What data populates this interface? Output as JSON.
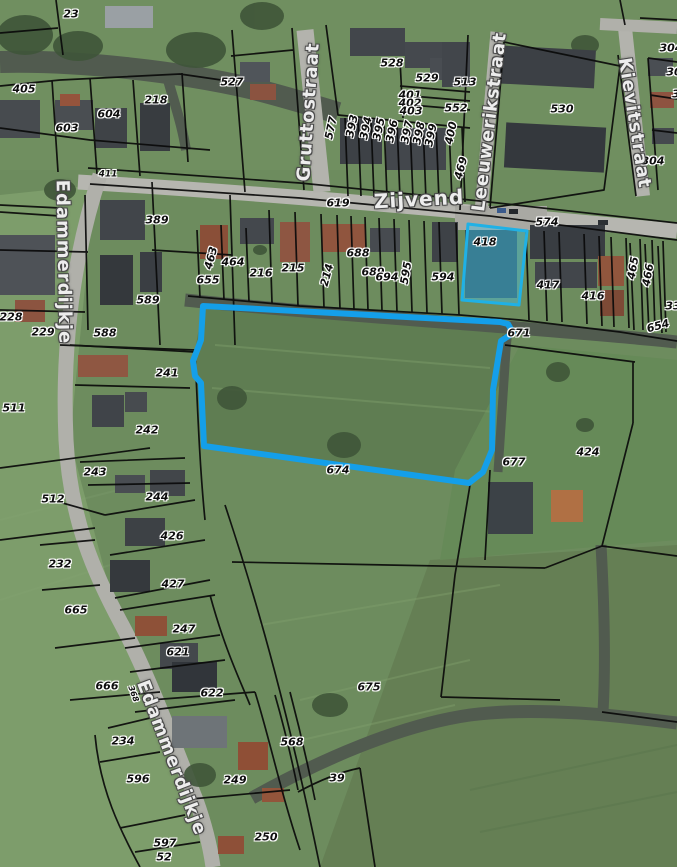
{
  "map": {
    "type": "cadastral-aerial-viewer",
    "colors": {
      "highlight_blue": "#149fe9",
      "highlight_parcel_fill": "rgba(70,195,235,0.42)",
      "highlight_parcel_stroke": "#1fb1e6",
      "parcel_line": "#0a0a0a",
      "water": "#515b4f",
      "road": "#b5b5af",
      "field": "#6d8c5e"
    },
    "highlight": {
      "field_parcel_points": "203,306 500,322 508,324 513,333 501,341 493,390 492,450 483,472 469,483 204,446 201,383 195,376 193,361 201,340",
      "building_parcel_points": "468,224 527,231 523,268 519,305 462,300",
      "building_parcel_label": "418"
    },
    "street_labels": [
      {
        "text": "Zijvend",
        "x": 419,
        "y": 199,
        "rot": -3,
        "size": 20
      },
      {
        "text": "Gruttostraat",
        "x": 309,
        "y": 112,
        "rot": -86,
        "size": 18
      },
      {
        "text": "Leeuwerikstraat",
        "x": 490,
        "y": 122,
        "rot": -83,
        "size": 18
      },
      {
        "text": "Kievitstraat",
        "x": 634,
        "y": 123,
        "rot": 81,
        "size": 18
      },
      {
        "text": "Edammerdijkje",
        "x": 63,
        "y": 262,
        "rot": 89,
        "size": 18
      },
      {
        "text": "Edammerdijkje",
        "x": 171,
        "y": 758,
        "rot": 69,
        "size": 18
      }
    ],
    "parcel_labels": [
      {
        "text": "23",
        "x": 71,
        "y": 14
      },
      {
        "text": "405",
        "x": 24,
        "y": 89
      },
      {
        "text": "603",
        "x": 67,
        "y": 128
      },
      {
        "text": "604",
        "x": 109,
        "y": 114
      },
      {
        "text": "218",
        "x": 156,
        "y": 100
      },
      {
        "text": "527",
        "x": 232,
        "y": 82
      },
      {
        "text": "528",
        "x": 392,
        "y": 63
      },
      {
        "text": "529",
        "x": 427,
        "y": 78
      },
      {
        "text": "513",
        "x": 465,
        "y": 82
      },
      {
        "text": "401",
        "x": 410,
        "y": 95
      },
      {
        "text": "402",
        "x": 410,
        "y": 103
      },
      {
        "text": "403",
        "x": 411,
        "y": 111
      },
      {
        "text": "552",
        "x": 456,
        "y": 108
      },
      {
        "text": "530",
        "x": 562,
        "y": 109
      },
      {
        "text": "304",
        "x": 671,
        "y": 48
      },
      {
        "text": "30",
        "x": 674,
        "y": 72
      },
      {
        "text": "3",
        "x": 676,
        "y": 94
      },
      {
        "text": "304",
        "x": 653,
        "y": 161
      },
      {
        "text": "577",
        "x": 331,
        "y": 128,
        "rot": -78
      },
      {
        "text": "393",
        "x": 352,
        "y": 126,
        "rot": -78
      },
      {
        "text": "394",
        "x": 366,
        "y": 128,
        "rot": -78
      },
      {
        "text": "395",
        "x": 379,
        "y": 129,
        "rot": -78
      },
      {
        "text": "396",
        "x": 392,
        "y": 131,
        "rot": -78
      },
      {
        "text": "397",
        "x": 407,
        "y": 132,
        "rot": -78
      },
      {
        "text": "398",
        "x": 419,
        "y": 133,
        "rot": -78
      },
      {
        "text": "399",
        "x": 431,
        "y": 135,
        "rot": -78
      },
      {
        "text": "400",
        "x": 451,
        "y": 133,
        "rot": -78
      },
      {
        "text": "469",
        "x": 461,
        "y": 168,
        "rot": -75
      },
      {
        "text": "411",
        "x": 108,
        "y": 175,
        "size": 9
      },
      {
        "text": "619",
        "x": 338,
        "y": 203
      },
      {
        "text": "574",
        "x": 547,
        "y": 222
      },
      {
        "text": "418",
        "x": 485,
        "y": 242
      },
      {
        "text": "389",
        "x": 157,
        "y": 220
      },
      {
        "text": "655",
        "x": 208,
        "y": 280
      },
      {
        "text": "463",
        "x": 211,
        "y": 258,
        "rot": -75
      },
      {
        "text": "464",
        "x": 233,
        "y": 262
      },
      {
        "text": "216",
        "x": 261,
        "y": 273
      },
      {
        "text": "215",
        "x": 293,
        "y": 268
      },
      {
        "text": "214",
        "x": 327,
        "y": 275,
        "rot": -75
      },
      {
        "text": "688",
        "x": 358,
        "y": 253
      },
      {
        "text": "689",
        "x": 373,
        "y": 272
      },
      {
        "text": "694",
        "x": 387,
        "y": 277
      },
      {
        "text": "595",
        "x": 406,
        "y": 273,
        "rot": -80
      },
      {
        "text": "594",
        "x": 443,
        "y": 277
      },
      {
        "text": "417",
        "x": 548,
        "y": 285
      },
      {
        "text": "416",
        "x": 593,
        "y": 296
      },
      {
        "text": "465",
        "x": 633,
        "y": 268,
        "rot": -80
      },
      {
        "text": "466",
        "x": 648,
        "y": 275,
        "rot": -80
      },
      {
        "text": "33",
        "x": 673,
        "y": 306
      },
      {
        "text": "654",
        "x": 658,
        "y": 326,
        "rot": -15
      },
      {
        "text": "671",
        "x": 519,
        "y": 333
      },
      {
        "text": "589",
        "x": 148,
        "y": 300
      },
      {
        "text": "588",
        "x": 105,
        "y": 333
      },
      {
        "text": "228",
        "x": 11,
        "y": 317
      },
      {
        "text": "229",
        "x": 43,
        "y": 332
      },
      {
        "text": "511",
        "x": 14,
        "y": 408
      },
      {
        "text": "241",
        "x": 167,
        "y": 373
      },
      {
        "text": "242",
        "x": 147,
        "y": 430
      },
      {
        "text": "243",
        "x": 95,
        "y": 472
      },
      {
        "text": "512",
        "x": 53,
        "y": 499
      },
      {
        "text": "244",
        "x": 157,
        "y": 497
      },
      {
        "text": "674",
        "x": 338,
        "y": 470
      },
      {
        "text": "677",
        "x": 514,
        "y": 462
      },
      {
        "text": "424",
        "x": 588,
        "y": 452
      },
      {
        "text": "426",
        "x": 172,
        "y": 536
      },
      {
        "text": "232",
        "x": 60,
        "y": 564
      },
      {
        "text": "427",
        "x": 173,
        "y": 584
      },
      {
        "text": "665",
        "x": 76,
        "y": 610
      },
      {
        "text": "247",
        "x": 184,
        "y": 629
      },
      {
        "text": "621",
        "x": 178,
        "y": 652
      },
      {
        "text": "666",
        "x": 107,
        "y": 686
      },
      {
        "text": "622",
        "x": 212,
        "y": 693
      },
      {
        "text": "368",
        "x": 133,
        "y": 694,
        "rot": 70,
        "size": 8
      },
      {
        "text": "234",
        "x": 123,
        "y": 741
      },
      {
        "text": "568",
        "x": 292,
        "y": 742
      },
      {
        "text": "596",
        "x": 138,
        "y": 779
      },
      {
        "text": "249",
        "x": 235,
        "y": 780
      },
      {
        "text": "675",
        "x": 369,
        "y": 687
      },
      {
        "text": "39",
        "x": 337,
        "y": 778
      },
      {
        "text": "250",
        "x": 266,
        "y": 837
      },
      {
        "text": "597",
        "x": 165,
        "y": 843
      },
      {
        "text": "52",
        "x": 164,
        "y": 857
      }
    ]
  }
}
